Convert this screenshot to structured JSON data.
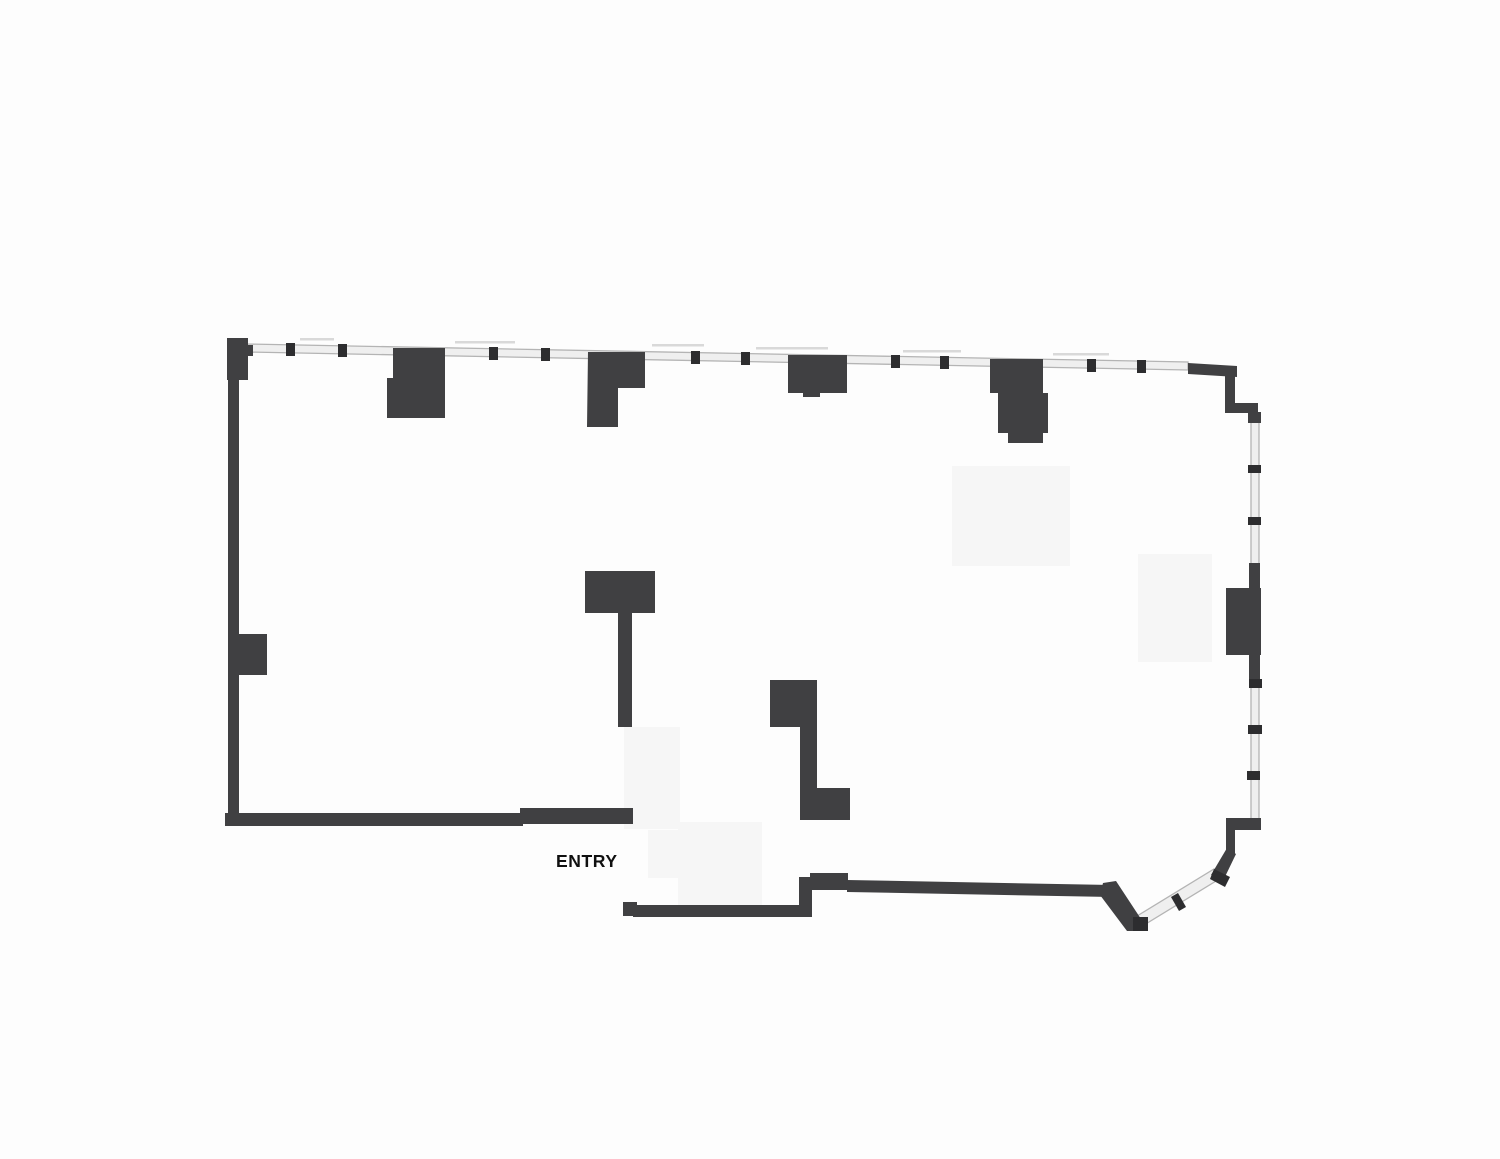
{
  "page": {
    "width": 1500,
    "height": 1159,
    "background": "#fdfdfd"
  },
  "plan": {
    "entry_label": "ENTRY",
    "colors": {
      "wall": "#404042",
      "mullion": "#2d2d2f",
      "window_fill": "#efefef",
      "window_edge": "#b4b4b4",
      "patch": "#f6f6f6",
      "annotation": "#d9d9d9",
      "label": "#101010"
    },
    "patches": [
      [
        952,
        466,
        118,
        100
      ],
      [
        1138,
        554,
        74,
        108
      ],
      [
        624,
        727,
        56,
        102
      ],
      [
        678,
        822,
        84,
        86
      ],
      [
        648,
        830,
        46,
        48
      ]
    ],
    "windows": [
      {
        "name": "top-window",
        "points": [
          [
            246,
            344
          ],
          [
            1188,
            362
          ],
          [
            1188,
            370
          ],
          [
            246,
            352
          ]
        ]
      },
      {
        "name": "right-window",
        "points": [
          [
            1251,
            417
          ],
          [
            1259,
            417
          ],
          [
            1259,
            820
          ],
          [
            1251,
            820
          ]
        ]
      },
      {
        "name": "angled-window",
        "points": [
          [
            1214,
            869
          ],
          [
            1221,
            878
          ],
          [
            1144,
            925
          ],
          [
            1137,
            916
          ]
        ]
      }
    ],
    "annotations": [
      [
        300,
        338,
        34
      ],
      [
        455,
        341,
        60
      ],
      [
        652,
        344,
        52
      ],
      [
        756,
        347,
        72
      ],
      [
        903,
        350,
        58
      ],
      [
        1053,
        353,
        56
      ]
    ],
    "walls": [
      {
        "name": "left-wall",
        "rect": [
          228,
          338,
          11,
          488
        ]
      },
      {
        "name": "left-corner-pier",
        "rect": [
          227,
          338,
          21,
          42
        ]
      },
      {
        "name": "left-corner-tab",
        "rect": [
          243,
          345,
          10,
          11
        ]
      },
      {
        "name": "left-wall-column",
        "rect": [
          239,
          634,
          28,
          41
        ]
      },
      {
        "name": "column-a",
        "points": [
          [
            393,
            348
          ],
          [
            445,
            348
          ],
          [
            445,
            418
          ],
          [
            387,
            418
          ],
          [
            387,
            378
          ],
          [
            393,
            378
          ]
        ]
      },
      {
        "name": "column-b",
        "points": [
          [
            588,
            352
          ],
          [
            645,
            352
          ],
          [
            645,
            388
          ],
          [
            618,
            388
          ],
          [
            618,
            427
          ],
          [
            587,
            427
          ]
        ]
      },
      {
        "name": "column-c",
        "points": [
          [
            788,
            355
          ],
          [
            847,
            355
          ],
          [
            847,
            393
          ],
          [
            820,
            393
          ],
          [
            820,
            397
          ],
          [
            803,
            397
          ],
          [
            803,
            393
          ],
          [
            788,
            393
          ]
        ]
      },
      {
        "name": "column-d",
        "points": [
          [
            990,
            359
          ],
          [
            1043,
            359
          ],
          [
            1043,
            393
          ],
          [
            1048,
            393
          ],
          [
            1048,
            433
          ],
          [
            1043,
            433
          ],
          [
            1043,
            443
          ],
          [
            1008,
            443
          ],
          [
            1008,
            433
          ],
          [
            998,
            433
          ],
          [
            998,
            393
          ],
          [
            990,
            393
          ]
        ]
      },
      {
        "name": "t-wall",
        "points": [
          [
            585,
            571
          ],
          [
            655,
            571
          ],
          [
            655,
            613
          ],
          [
            632,
            613
          ],
          [
            632,
            727
          ],
          [
            618,
            727
          ],
          [
            618,
            613
          ],
          [
            585,
            613
          ]
        ]
      },
      {
        "name": "j-wall",
        "points": [
          [
            770,
            680
          ],
          [
            817,
            680
          ],
          [
            817,
            788
          ],
          [
            850,
            788
          ],
          [
            850,
            820
          ],
          [
            800,
            820
          ],
          [
            800,
            727
          ],
          [
            770,
            727
          ]
        ]
      },
      {
        "name": "bottom-left-wall",
        "rect": [
          225,
          813,
          298,
          13
        ]
      },
      {
        "name": "bottom-left-wall-end",
        "rect": [
          520,
          808,
          113,
          16
        ]
      },
      {
        "name": "entry-south-cap",
        "rect": [
          623,
          902,
          14,
          14
        ]
      },
      {
        "name": "bottom-mid-wall",
        "rect": [
          633,
          905,
          174,
          12
        ]
      },
      {
        "name": "bottom-step-wall",
        "rect": [
          799,
          877,
          13,
          40
        ]
      },
      {
        "name": "bottom-mid-pier",
        "rect": [
          810,
          873,
          38,
          17
        ]
      },
      {
        "name": "bottom-right-wall",
        "points": [
          [
            847,
            880
          ],
          [
            1112,
            885
          ],
          [
            1112,
            897
          ],
          [
            847,
            892
          ]
        ]
      },
      {
        "name": "bottom-angled-wall",
        "points": [
          [
            1103,
            883
          ],
          [
            1116,
            881
          ],
          [
            1141,
            919
          ],
          [
            1141,
            931
          ],
          [
            1127,
            931
          ],
          [
            1100,
            895
          ]
        ]
      },
      {
        "name": "corner-angled-wall",
        "points": [
          [
            1211,
            875
          ],
          [
            1222,
            883
          ],
          [
            1236,
            854
          ],
          [
            1227,
            848
          ]
        ]
      },
      {
        "name": "right-lower-wall",
        "rect": [
          1226,
          818,
          9,
          36
        ]
      },
      {
        "name": "right-lower-step",
        "rect": [
          1226,
          818,
          35,
          12
        ]
      },
      {
        "name": "right-top-wall",
        "points": [
          [
            1188,
            363
          ],
          [
            1237,
            366
          ],
          [
            1237,
            377
          ],
          [
            1188,
            374
          ]
        ]
      },
      {
        "name": "right-upper-wall",
        "rect": [
          1225,
          366,
          10,
          47
        ]
      },
      {
        "name": "right-upper-step",
        "rect": [
          1225,
          403,
          33,
          10
        ]
      },
      {
        "name": "right-window-head",
        "rect": [
          1248,
          412,
          13,
          11
        ]
      },
      {
        "name": "right-wall-a",
        "rect": [
          1249,
          563,
          11,
          28
        ]
      },
      {
        "name": "right-column",
        "rect": [
          1226,
          588,
          35,
          67
        ]
      },
      {
        "name": "right-wall-b",
        "rect": [
          1249,
          655,
          11,
          27
        ]
      }
    ],
    "mullions": [
      {
        "name": "top-mullion-1",
        "rect": [
          286,
          343,
          9,
          13
        ]
      },
      {
        "name": "top-mullion-2",
        "rect": [
          338,
          344,
          9,
          13
        ]
      },
      {
        "name": "top-mullion-3",
        "rect": [
          489,
          347,
          9,
          13
        ]
      },
      {
        "name": "top-mullion-4",
        "rect": [
          541,
          348,
          9,
          13
        ]
      },
      {
        "name": "top-mullion-5",
        "rect": [
          691,
          351,
          9,
          13
        ]
      },
      {
        "name": "top-mullion-6",
        "rect": [
          741,
          352,
          9,
          13
        ]
      },
      {
        "name": "top-mullion-7",
        "rect": [
          891,
          355,
          9,
          13
        ]
      },
      {
        "name": "top-mullion-8",
        "rect": [
          940,
          356,
          9,
          13
        ]
      },
      {
        "name": "top-mullion-9",
        "rect": [
          1087,
          359,
          9,
          13
        ]
      },
      {
        "name": "top-mullion-10",
        "rect": [
          1137,
          360,
          9,
          13
        ]
      },
      {
        "name": "right-mullion-1",
        "rect": [
          1248,
          465,
          13,
          8
        ]
      },
      {
        "name": "right-mullion-2",
        "rect": [
          1248,
          517,
          13,
          8
        ]
      },
      {
        "name": "right-mullion-3",
        "rect": [
          1249,
          679,
          13,
          9
        ]
      },
      {
        "name": "right-mullion-4",
        "rect": [
          1248,
          725,
          14,
          9
        ]
      },
      {
        "name": "right-mullion-5",
        "rect": [
          1247,
          771,
          13,
          9
        ]
      },
      {
        "name": "angled-mullion-top",
        "points": [
          [
            1214,
            869
          ],
          [
            1230,
            877
          ],
          [
            1225,
            887
          ],
          [
            1210,
            879
          ]
        ]
      },
      {
        "name": "angled-mullion-mid",
        "points": [
          [
            1178,
            893
          ],
          [
            1186,
            907
          ],
          [
            1179,
            911
          ],
          [
            1171,
            897
          ]
        ]
      },
      {
        "name": "angled-window-end",
        "rect": [
          1133,
          917,
          15,
          14
        ]
      }
    ]
  }
}
